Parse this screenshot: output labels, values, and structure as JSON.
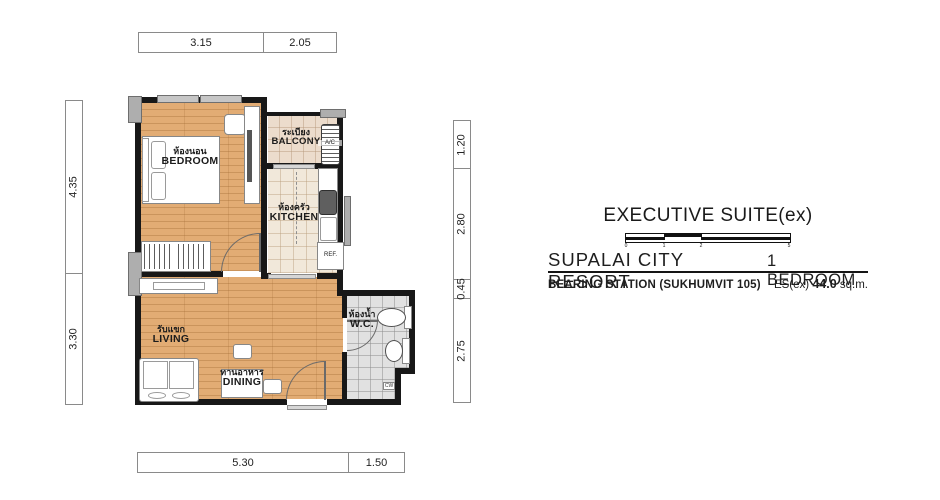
{
  "title": {
    "heading": "EXECUTIVE SUITE(ex)",
    "project": "SUPALAI CITY RESORT",
    "unit_type": "1 BEDROOM",
    "station": "BEARING STATION (SUKHUMVIT 105)",
    "area_prefix": "ES(ex)",
    "area_value": "44.0",
    "area_unit": "sq.m.",
    "scale_ticks": [
      "0",
      "1",
      "2",
      "5"
    ]
  },
  "dims": {
    "top": [
      "3.15",
      "2.05"
    ],
    "bottom": [
      "5.30",
      "1.50"
    ],
    "left": [
      "4.35",
      "3.30"
    ],
    "right": [
      "1.20",
      "2.80",
      "0.45",
      "2.75"
    ]
  },
  "rooms": {
    "bedroom": {
      "thai": "ห้องนอน",
      "en": "BEDROOM"
    },
    "balcony": {
      "thai": "ระเบียง",
      "en": "BALCONY"
    },
    "kitchen": {
      "thai": "ห้องครัว",
      "en": "KITCHEN"
    },
    "living": {
      "thai": "รับแขก",
      "en": "LIVING"
    },
    "dining": {
      "thai": "ทานอาหาร",
      "en": "DINING"
    },
    "wc": {
      "thai": "ห้องน้ำ",
      "en": "W.C."
    }
  },
  "fixtures": {
    "fridge": "REF.",
    "ac": "A/C",
    "cw": "CW"
  },
  "colors": {
    "wall": "#181818",
    "wood_floor": "#e2ac74",
    "kitchen_tile": "#f1e8da",
    "balcony_tile": "#ecdccc",
    "wc_tile": "#e1e1e1",
    "column_gray": "#aeaeae"
  }
}
